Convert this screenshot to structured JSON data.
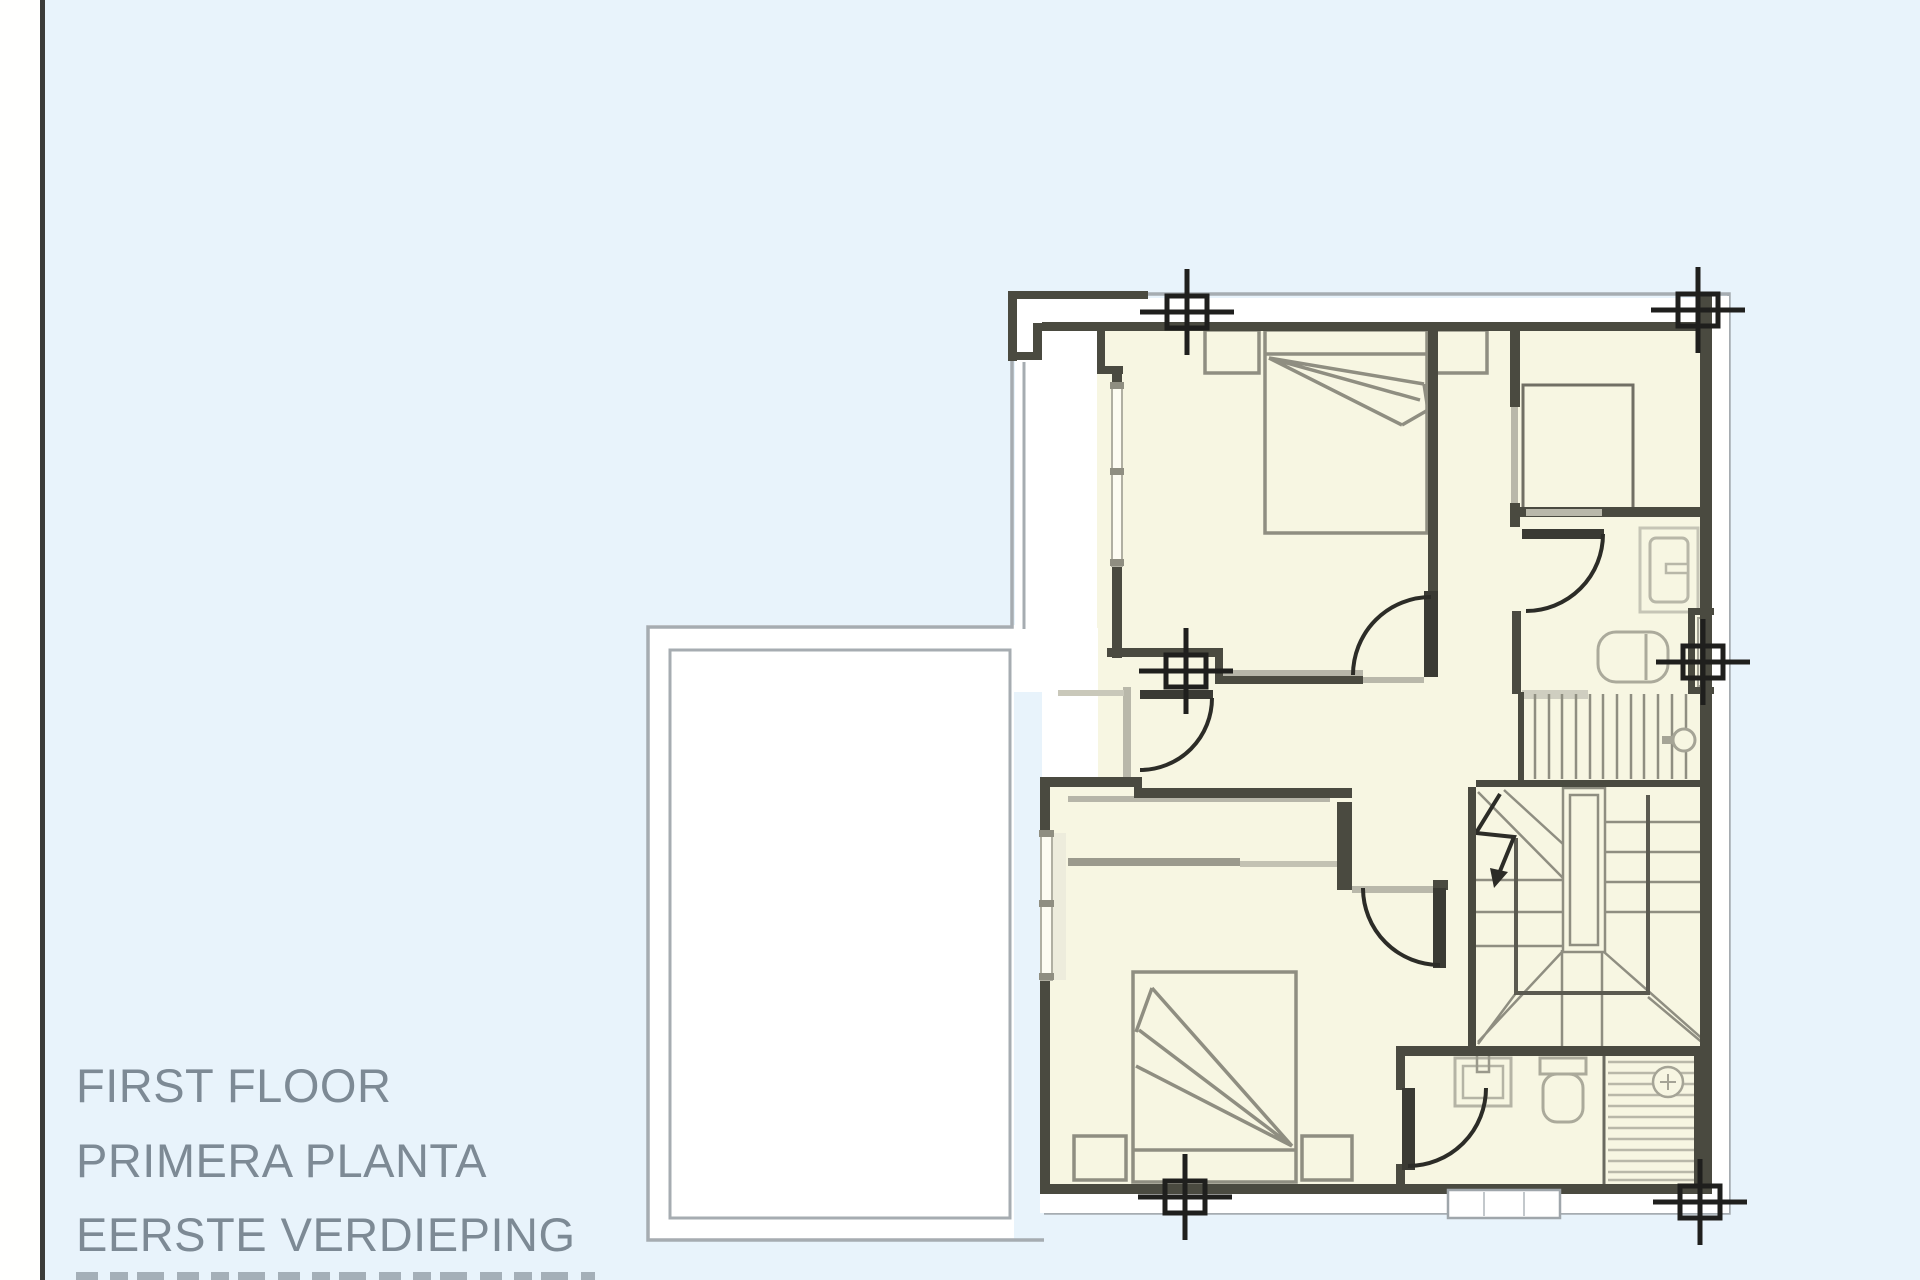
{
  "page": {
    "background_color": "#e8f3fb",
    "paper_margin_color": "#fffffe",
    "paper_edge_rule_color": "#3b3b39"
  },
  "title_block": {
    "lines": [
      "FIRST FLOOR",
      "PRIMERA PLANTA",
      "EERSTE VERDIEPING"
    ],
    "text_color": "#7d8a95"
  },
  "floor_plan": {
    "type": "architectural-floor-plan",
    "room_fill_color": "#f7f6e2",
    "wall_color": "#4a4a40",
    "furniture_line_color": "#8f8e81",
    "fixture_line_color": "#b2b1a2",
    "roof_outline_color": "#a6acb1",
    "registration_mark_color": "#1f1f1d",
    "registration_mark_count": 6
  }
}
